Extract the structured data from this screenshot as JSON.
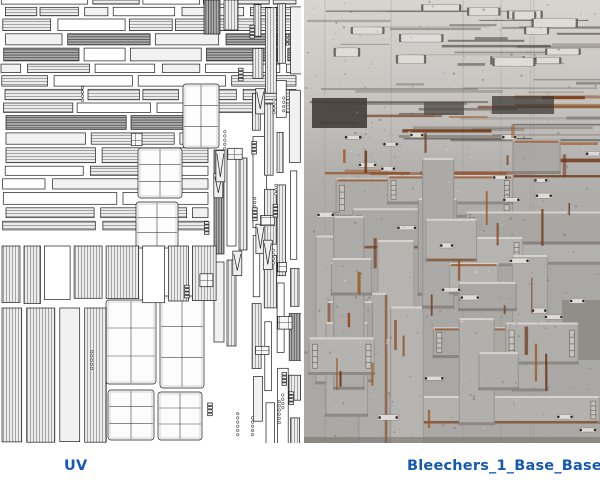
{
  "captions": {
    "uv": "UV",
    "texture": "Bleechers_1_Base_BaseCol"
  },
  "style": {
    "caption_color": "#1659b5",
    "page_bg": "#ffffff"
  },
  "panels": {
    "uv": {
      "bg": "#ffffff",
      "line": "#1c1c1c",
      "fill_light": "#ececec",
      "fill_plain": "#ffffff",
      "fill_mid": "#f1f1f1",
      "fill_dark": "#aeaeae",
      "stripe": "#9c9c9c",
      "stripe_dark": "#555555"
    },
    "texture": {
      "base": "#aaa8a5",
      "top": "#d8d5d1",
      "mid": "#b3b1ae",
      "highlight": "#dcd9d5",
      "shadow": "#5f5b57",
      "seam": "#55504a",
      "rust": "#8a4318",
      "rust_dark": "#6e3412",
      "rust_light": "#9c5a28",
      "metal": "#dfdcd8",
      "cap_dark": "#2f2c29",
      "dark_block": "#454039",
      "speckle": "#6f6b66"
    }
  }
}
